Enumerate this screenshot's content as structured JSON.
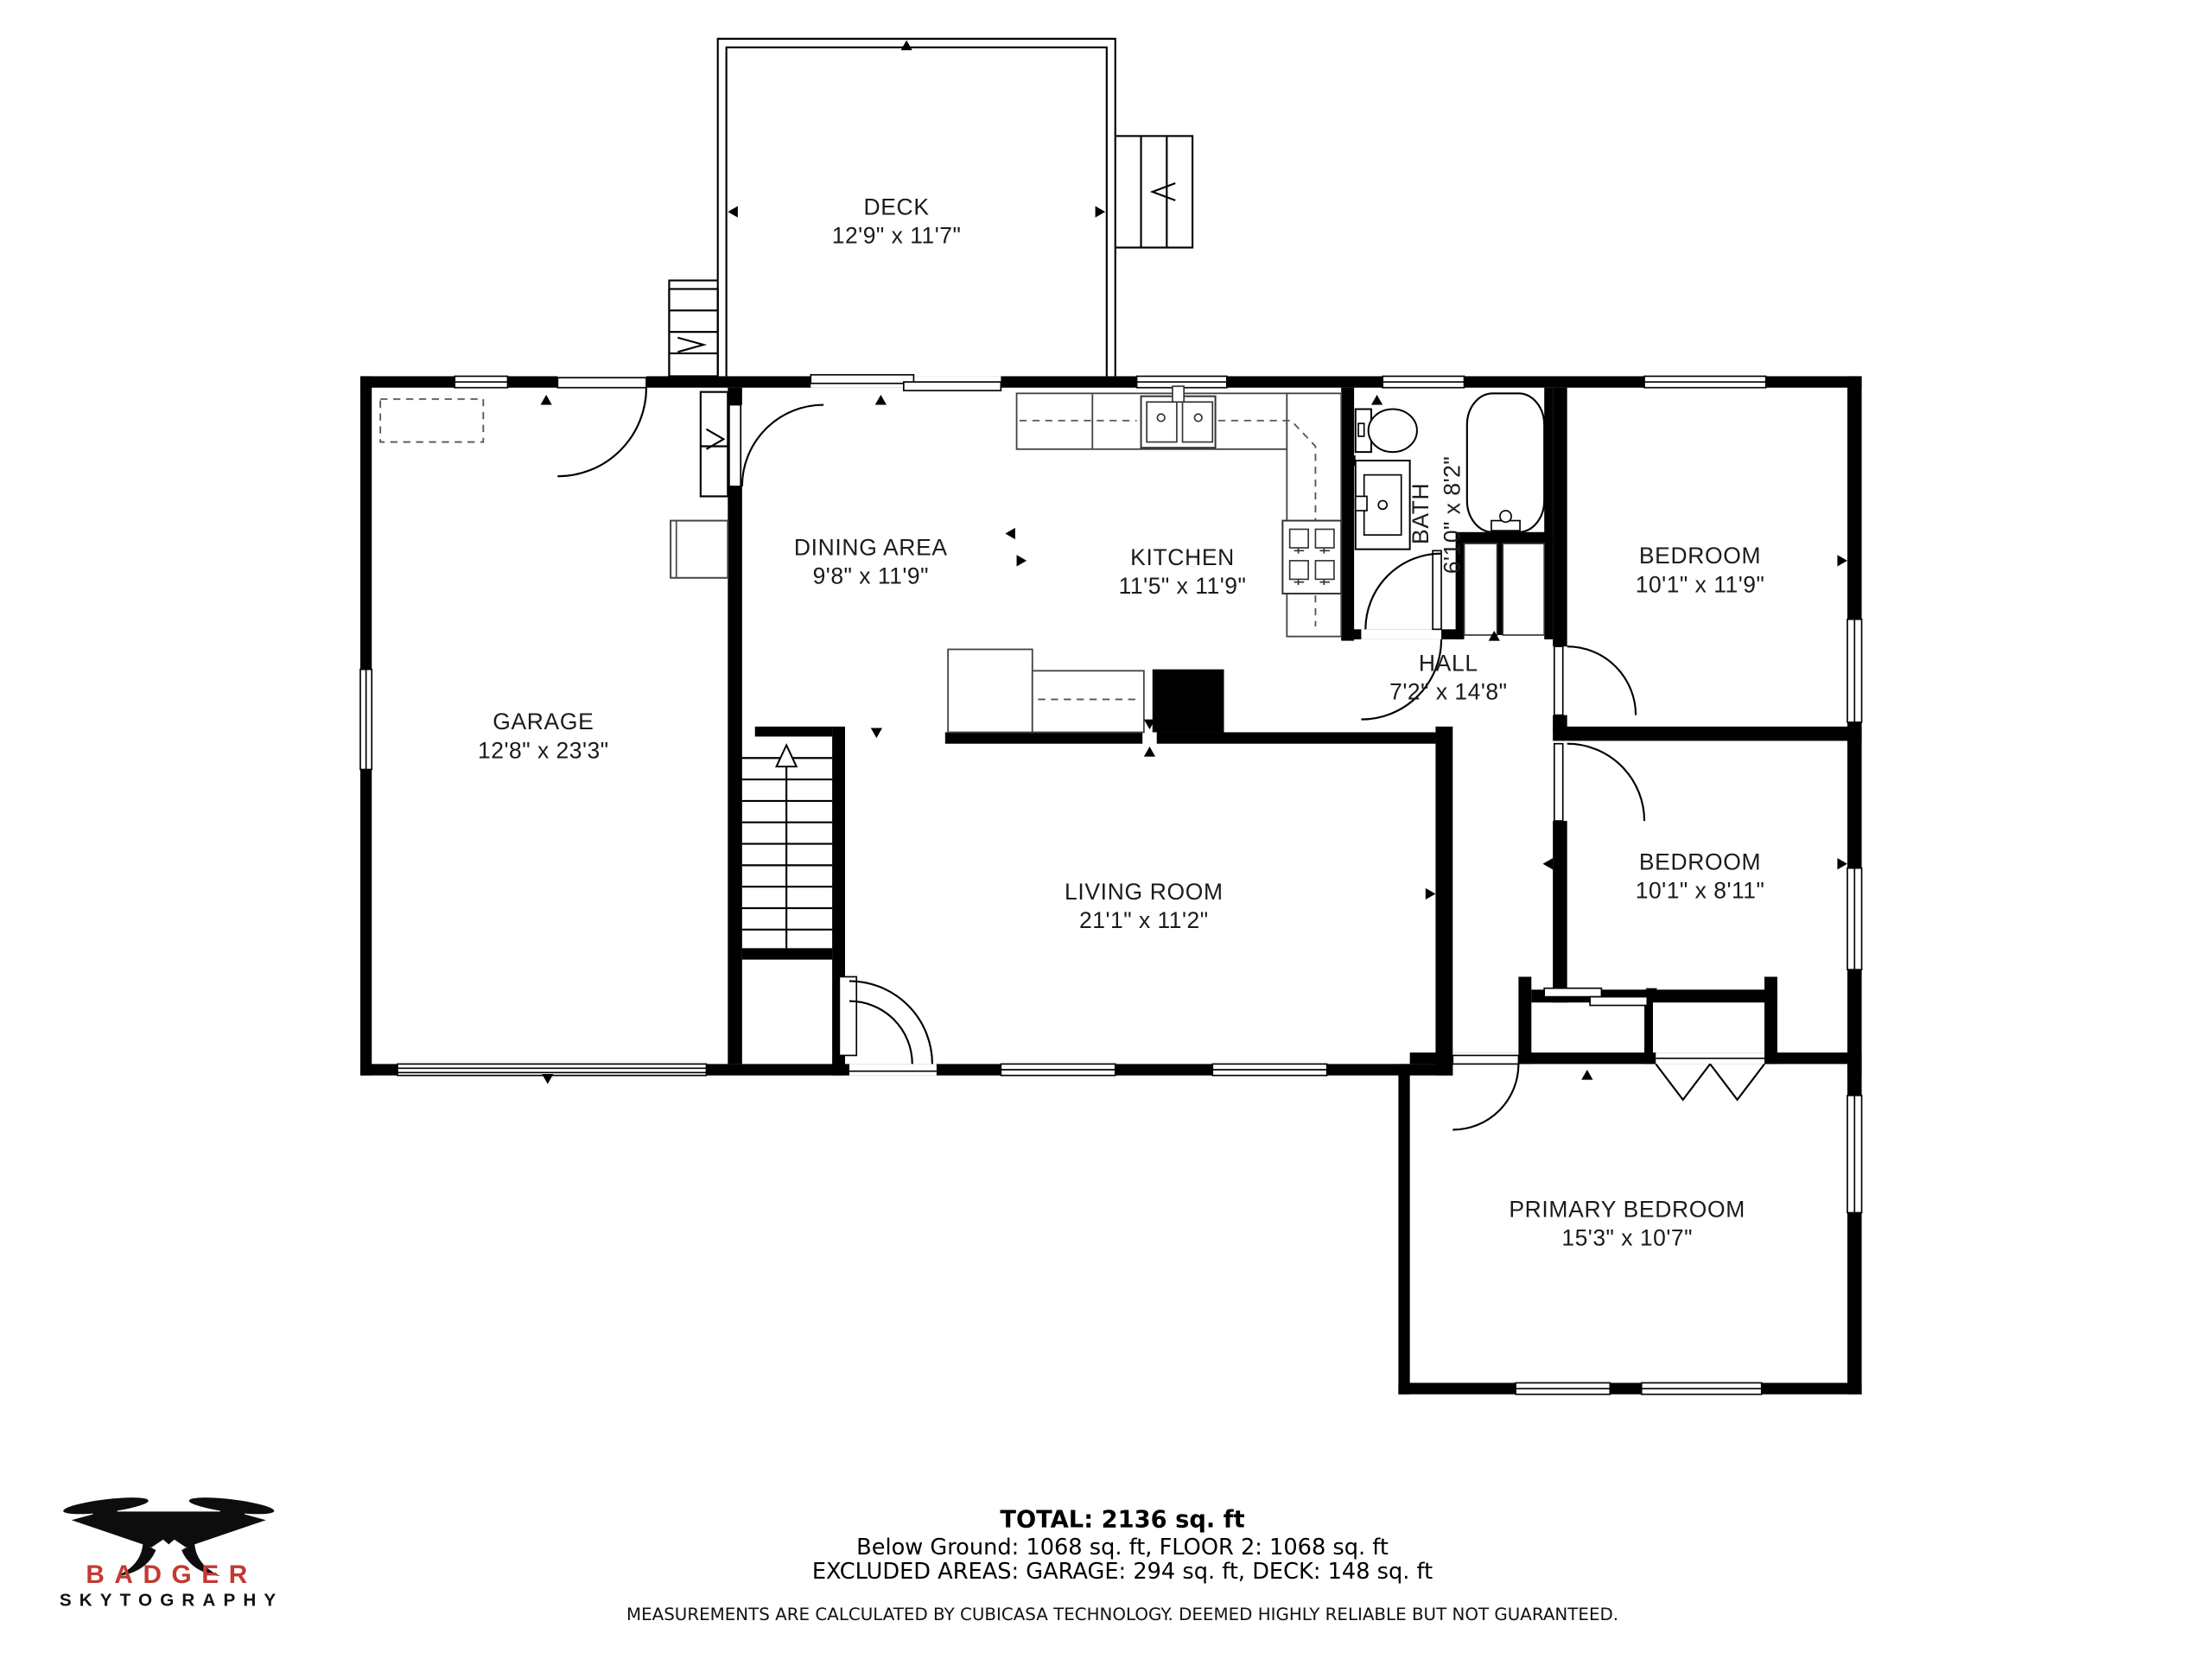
{
  "plan": {
    "rooms": [
      {
        "key": "deck",
        "name": "DECK",
        "dims": "12'9\" x 11'7\""
      },
      {
        "key": "dining",
        "name": "DINING AREA",
        "dims": "9'8\" x 11'9\""
      },
      {
        "key": "kitchen",
        "name": "KITCHEN",
        "dims": "11'5\" x 11'9\""
      },
      {
        "key": "bath",
        "name": "BATH",
        "dims": "6'10\" x 8'2\""
      },
      {
        "key": "bedroom1",
        "name": "BEDROOM",
        "dims": "10'1\" x 11'9\""
      },
      {
        "key": "garage",
        "name": "GARAGE",
        "dims": "12'8\" x 23'3\""
      },
      {
        "key": "hall",
        "name": "HALL",
        "dims": "7'2\" x 14'8\""
      },
      {
        "key": "living",
        "name": "LIVING ROOM",
        "dims": "21'1\" x 11'2\""
      },
      {
        "key": "bedroom2",
        "name": "BEDROOM",
        "dims": "10'1\" x 8'11\""
      },
      {
        "key": "primary",
        "name": "PRIMARY BEDROOM",
        "dims": "15'3\" x 10'7\""
      }
    ]
  },
  "summary": {
    "total": "TOTAL: 2136 sq. ft",
    "line2": "Below Ground: 1068 sq. ft, FLOOR 2: 1068 sq. ft",
    "line3": "EXCLUDED AREAS: GARAGE: 294 sq. ft, DECK: 148 sq. ft",
    "disclaimer": "MEASUREMENTS ARE CALCULATED BY CUBICASA TECHNOLOGY. DEEMED HIGHLY RELIABLE BUT NOT GUARANTEED."
  },
  "logo": {
    "brand": "BADGER",
    "subtitle": "SKYTOGRAPHY",
    "brand_color": "#c23a32"
  },
  "colors": {
    "wall": "#000000",
    "background": "#ffffff",
    "accent_red": "#c23a32"
  }
}
